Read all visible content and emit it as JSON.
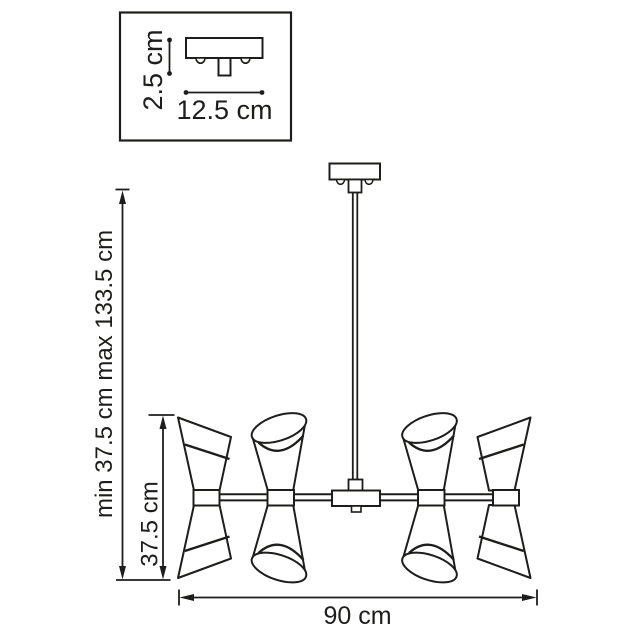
{
  "colors": {
    "line": "#1d1d1b",
    "background": "#ffffff"
  },
  "inset": {
    "height_label": "2.5 cm",
    "width_label": "12.5 cm"
  },
  "dimensions": {
    "hanging_height_label": "min 37.5 cm max 133.5 cm",
    "fixture_height_label": "37.5 cm",
    "fixture_width_label": "90 cm"
  }
}
